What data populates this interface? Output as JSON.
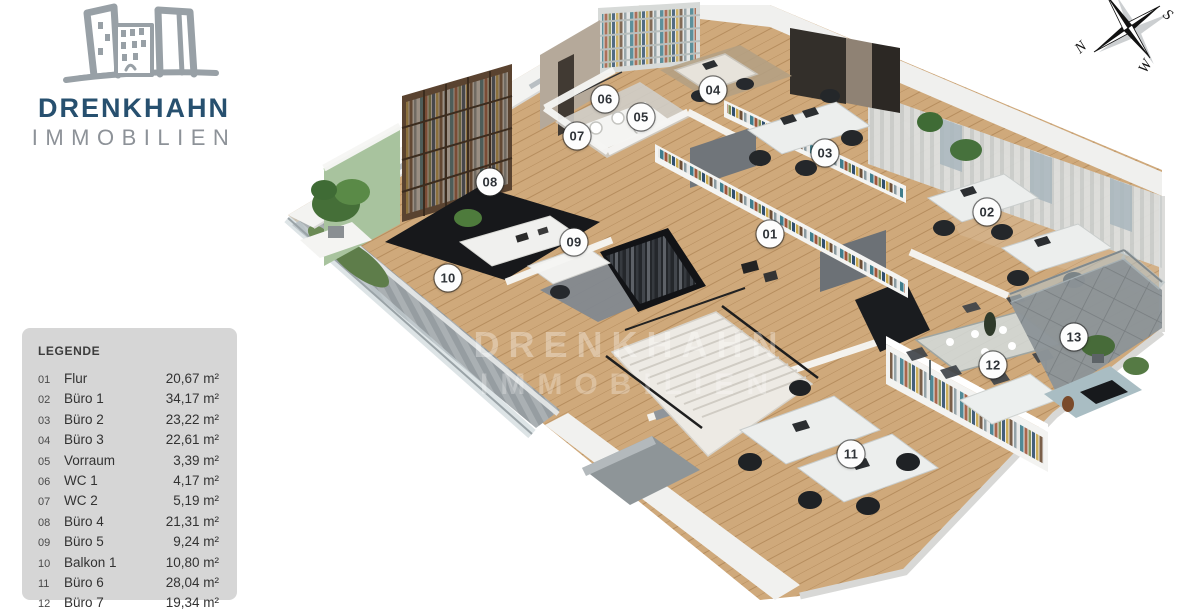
{
  "logo": {
    "line1": "DRENKHAHN",
    "line2": "IMMOBILIEN"
  },
  "watermark": {
    "line1": "DRENKHAHN",
    "line2": "IMMOBILIEN"
  },
  "compass": {
    "n": "N",
    "s": "S",
    "w": "W"
  },
  "legend": {
    "title": "LEGENDE",
    "rows": [
      {
        "num": "01",
        "name": "Flur",
        "area": "20,67 m²"
      },
      {
        "num": "02",
        "name": "Büro 1",
        "area": "34,17 m²"
      },
      {
        "num": "03",
        "name": "Büro 2",
        "area": "23,22 m²"
      },
      {
        "num": "04",
        "name": "Büro 3",
        "area": "22,61 m²"
      },
      {
        "num": "05",
        "name": "Vorraum",
        "area": "3,39 m²"
      },
      {
        "num": "06",
        "name": "WC 1",
        "area": "4,17 m²"
      },
      {
        "num": "07",
        "name": "WC 2",
        "area": "5,19 m²"
      },
      {
        "num": "08",
        "name": "Büro 4",
        "area": "21,31 m²"
      },
      {
        "num": "09",
        "name": "Büro 5",
        "area": "9,24 m²"
      },
      {
        "num": "10",
        "name": "Balkon 1",
        "area": "10,80 m²"
      },
      {
        "num": "11",
        "name": "Büro 6",
        "area": "28,04 m²"
      },
      {
        "num": "12",
        "name": "Büro 7",
        "area": "19,34 m²"
      }
    ]
  },
  "floorplan": {
    "markers": [
      {
        "label": "01",
        "x": 770,
        "y": 234
      },
      {
        "label": "02",
        "x": 987,
        "y": 212
      },
      {
        "label": "03",
        "x": 825,
        "y": 153
      },
      {
        "label": "04",
        "x": 713,
        "y": 90
      },
      {
        "label": "05",
        "x": 641,
        "y": 117
      },
      {
        "label": "06",
        "x": 605,
        "y": 99
      },
      {
        "label": "07",
        "x": 577,
        "y": 136
      },
      {
        "label": "08",
        "x": 490,
        "y": 182
      },
      {
        "label": "09",
        "x": 574,
        "y": 242
      },
      {
        "label": "10",
        "x": 448,
        "y": 278
      },
      {
        "label": "11",
        "x": 851,
        "y": 454
      },
      {
        "label": "12",
        "x": 993,
        "y": 365
      },
      {
        "label": "13",
        "x": 1074,
        "y": 337
      }
    ]
  },
  "colors": {
    "brand_blue": "#27506f",
    "brand_gray": "#8d9298",
    "legend_bg": "#d6d6d6",
    "legend_text": "#323232",
    "wood_floor": "#cfa97b",
    "accent_green_wall": "#a8c39e",
    "marker_bg": "#fdfdfd"
  }
}
